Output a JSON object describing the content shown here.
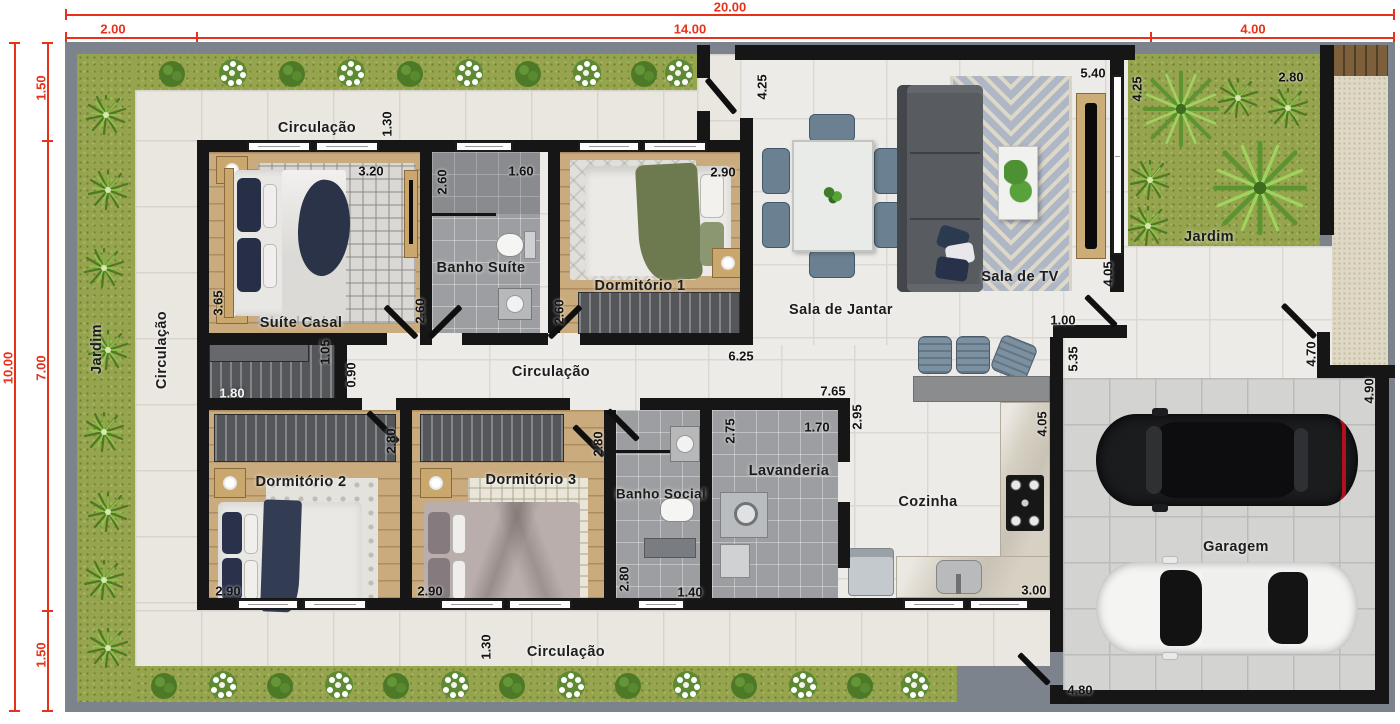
{
  "title": "Planta baixa - casa térrea 20x10",
  "colors": {
    "dimension_red": "#e8311a",
    "wall_black": "#161616",
    "grass_green": "#95a44d",
    "wood_floor": "#c9ab7e",
    "bath_tile_gray": "#9d9ea1",
    "accent_navy": "#2e3a50",
    "accent_green_blanket": "#6d7a4f"
  },
  "red_dimensions": {
    "total_width": "20.00",
    "width_seg_left": "2.00",
    "width_seg_mid": "14.00",
    "width_seg_right": "4.00",
    "total_height": "10.00",
    "height_seg_top": "1.50",
    "height_seg_mid": "7.00",
    "height_seg_bottom": "1.50"
  },
  "rooms": {
    "circulacao_top": "Circulação",
    "circulacao_left": "Circulação",
    "circulacao_middle": "Circulação",
    "circulacao_bottom": "Circulação",
    "jardim_left": "Jardim",
    "jardim_right": "Jardim",
    "suite_casal": "Suíte Casal",
    "banho_suite": "Banho Suíte",
    "dormitorio1": "Dormitório 1",
    "dormitorio2": "Dormitório 2",
    "dormitorio3": "Dormitório 3",
    "banho_social": "Banho Social",
    "lavanderia": "Lavanderia",
    "cozinha": "Cozinha",
    "sala_de_jantar": "Sala de Jantar",
    "sala_de_tv": "Sala de TV",
    "garagem": "Garagem"
  },
  "measurements": {
    "circ_top_width": "1.30",
    "suite_width": "3.20",
    "banho_suite_depth": "2.60",
    "banho_suite_width": "1.60",
    "dorm1_width": "2.90",
    "jantar_wall": "4.25",
    "tv_width": "5.40",
    "jardim_depth": "4.25",
    "jardim_width": "2.80",
    "suite_depth": "3.65",
    "suite_door": "2.60",
    "dorm1_door": "2.60",
    "closet_pass": "1.05",
    "hall_width": "0.90",
    "closet_width": "1.80",
    "jantar_width": "6.25",
    "cozinha_front": "7.65",
    "cozinha_depth": "2.95",
    "tv_depth": "4.05",
    "tv_pass": "1.00",
    "kitchen_side": "5.35",
    "cozinha_side": "4.05",
    "walkway_depth": "4.70",
    "garage_depth": "4.90",
    "dorm2_depth": "2.80",
    "dorm3_depth": "2.80",
    "lavanderia_depth": "2.75",
    "lavanderia_width": "1.70",
    "banho_social_depth": "2.80",
    "banho_social_width": "1.40",
    "dorm2_width": "2.90",
    "dorm3_width": "2.90",
    "cozinha_width": "3.00",
    "circ_bottom_width": "1.30",
    "garage_width": "4.80"
  }
}
